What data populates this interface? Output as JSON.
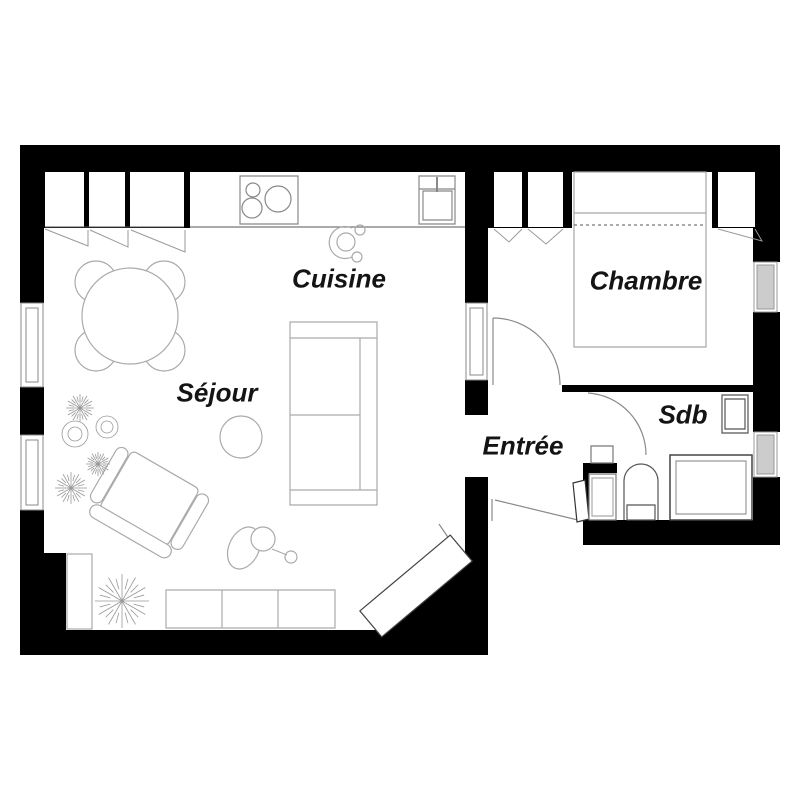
{
  "plan": {
    "title": "apartment-floor-plan",
    "rooms": [
      {
        "id": "cuisine",
        "label": "Cuisine"
      },
      {
        "id": "sejour",
        "label": "Séjour"
      },
      {
        "id": "chambre",
        "label": "Chambre"
      },
      {
        "id": "entree",
        "label": "Entrée"
      },
      {
        "id": "sdb",
        "label": "Sdb"
      }
    ],
    "colors": {
      "wall": "#000000",
      "furniture_outline": "#aaaaaa",
      "fixture_outline": "#555555",
      "window_glass": "#cccccc",
      "text": "#141414",
      "background": "#ffffff"
    }
  }
}
